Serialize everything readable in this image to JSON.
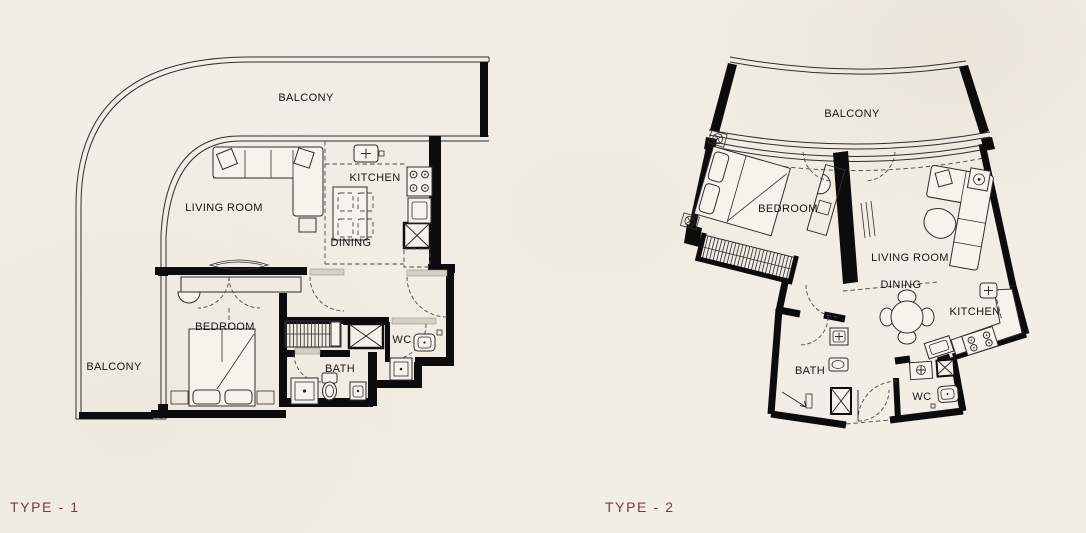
{
  "colors": {
    "background": "#f2eee7",
    "line": "#2e2e2e",
    "wall": "#0c0c0c",
    "type_label": "#7c3b33"
  },
  "plans": [
    {
      "name": "type-1",
      "type_label": "TYPE - 1",
      "rooms": {
        "balcony_top": "BALCONY",
        "balcony_side": "BALCONY",
        "living_room": "LIVING ROOM",
        "kitchen": "KITCHEN",
        "dining": "DINING",
        "bedroom": "BEDROOM",
        "bath": "BATH",
        "wc": "WC"
      }
    },
    {
      "name": "type-2",
      "type_label": "TYPE - 2",
      "rooms": {
        "balcony": "BALCONY",
        "bedroom": "BEDROOM",
        "living_room": "LIVING ROOM",
        "dining": "DINING",
        "kitchen": "KITCHEN",
        "bath": "BATH",
        "wc": "WC"
      }
    }
  ]
}
